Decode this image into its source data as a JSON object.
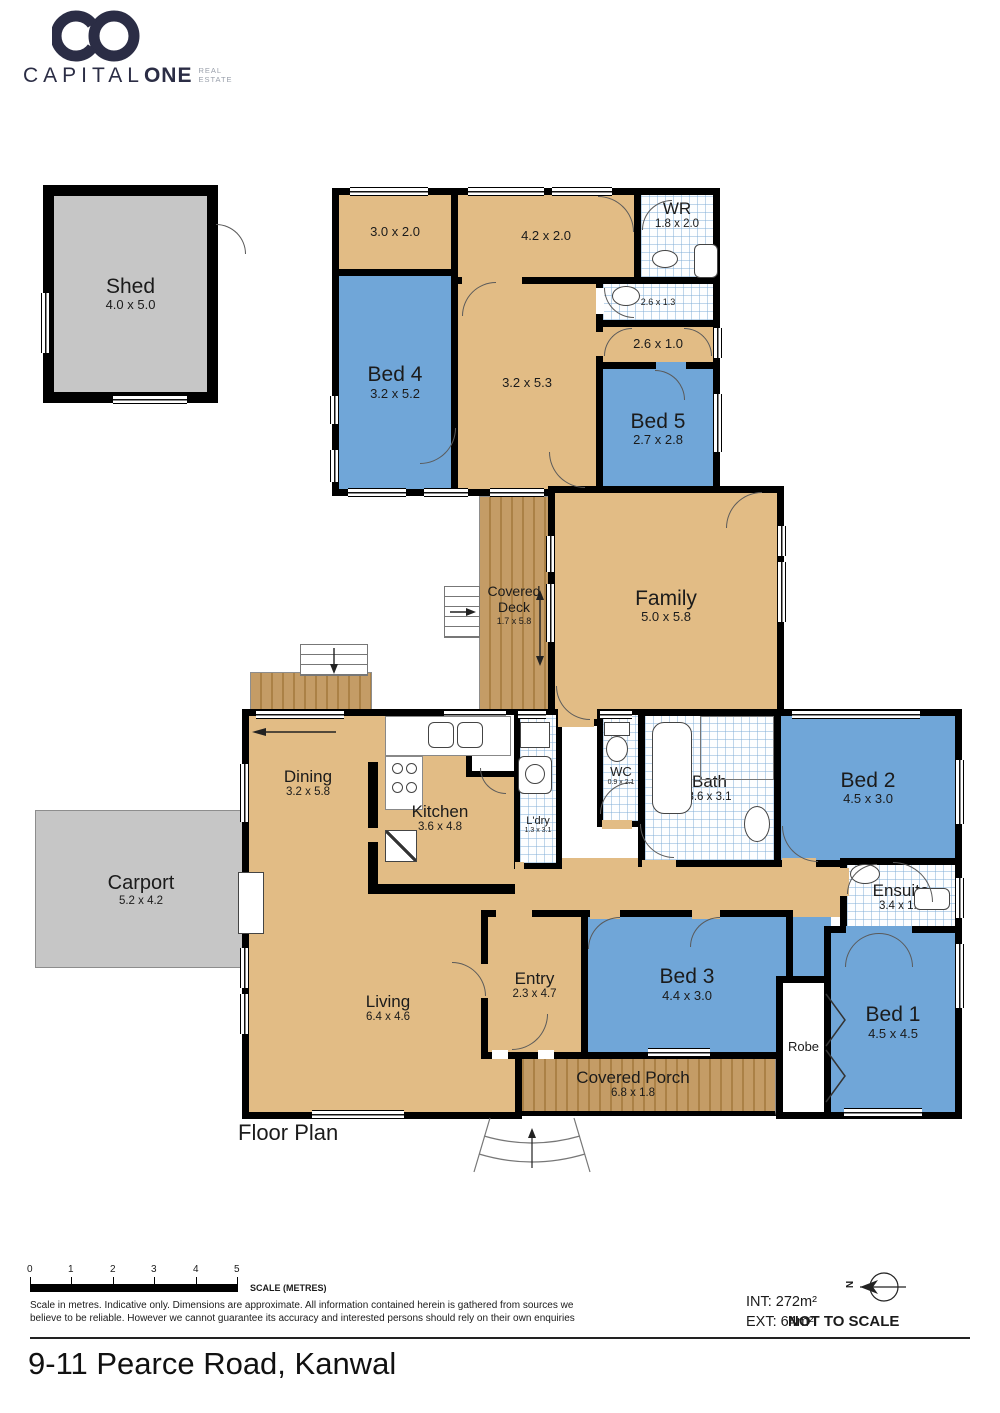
{
  "brand": {
    "monogram": "CO",
    "name_part1": "CAPITAL",
    "name_part2": "ONE",
    "tagline_line1": "REAL",
    "tagline_line2": "ESTATE"
  },
  "colors": {
    "tan": "#e2bc85",
    "blue": "#70a6d8",
    "wall": "#000000",
    "gray": "#c6c6c6",
    "wood": "#c49c66",
    "navy": "#2b2d45"
  },
  "rooms": {
    "shed": {
      "label": "Shed",
      "dims": "4.0 x 5.0"
    },
    "store_a": {
      "dims": "3.0 x 2.0"
    },
    "store_b": {
      "dims": "4.2 x 2.0"
    },
    "wr": {
      "label": "WR",
      "dims": "1.8 x 2.0"
    },
    "bath_small": {
      "dims": "2.6 x 1.3"
    },
    "hall_small": {
      "dims": "2.6 x 1.0"
    },
    "bed4": {
      "label": "Bed 4",
      "dims": "3.2 x 5.2"
    },
    "rumpus": {
      "dims": "3.2 x 5.3"
    },
    "bed5": {
      "label": "Bed 5",
      "dims": "2.7 x 2.8"
    },
    "deck": {
      "label": "Covered Deck",
      "dims": "1.7 x 5.8"
    },
    "family": {
      "label": "Family",
      "dims": "5.0 x 5.8"
    },
    "dining": {
      "label": "Dining",
      "dims": "3.2 x 5.8"
    },
    "kitchen": {
      "label": "Kitchen",
      "dims": "3.6 x 4.8"
    },
    "pantry": {
      "label": "P'try"
    },
    "laundry": {
      "label": "L'dry",
      "dims": "1.3 x 3.1"
    },
    "wc": {
      "label": "WC",
      "dims": "0.9 x 2.1"
    },
    "bath": {
      "label": "Bath",
      "dims": "3.6 x 3.1"
    },
    "bed2": {
      "label": "Bed 2",
      "dims": "4.5 x 3.0"
    },
    "ensuite": {
      "label": "Ensuite",
      "dims": "3.4 x 1.8"
    },
    "entry": {
      "label": "Entry",
      "dims": "2.3 x 4.7"
    },
    "bed3": {
      "label": "Bed 3",
      "dims": "4.4 x 3.0"
    },
    "robe": {
      "label": "Robe"
    },
    "bed1": {
      "label": "Bed 1",
      "dims": "4.5 x 4.5"
    },
    "living": {
      "label": "Living",
      "dims": "6.4 x 4.6"
    },
    "porch": {
      "label": "Covered Porch",
      "dims": "6.8 x 1.8"
    },
    "carport": {
      "label": "Carport",
      "dims": "5.2 x 4.2"
    }
  },
  "footer": {
    "plan_label": "Floor Plan",
    "scale": {
      "ticks": [
        "0",
        "1",
        "2",
        "3",
        "4",
        "5"
      ],
      "label": "SCALE (METRES)"
    },
    "disclaimer_line1": "Scale in metres. Indicative only. Dimensions are approximate. All information contained herein is gathered from sources we",
    "disclaimer_line2": "believe to be reliable. However we cannot guarantee its accuracy and interested persons should rely on their own enquiries",
    "int_label": "INT: 272m²",
    "ext_label": "EXT: 64m²",
    "not_to_scale": "NOT TO SCALE",
    "compass_n": "N"
  },
  "title": "9-11 Pearce Road, Kanwal"
}
